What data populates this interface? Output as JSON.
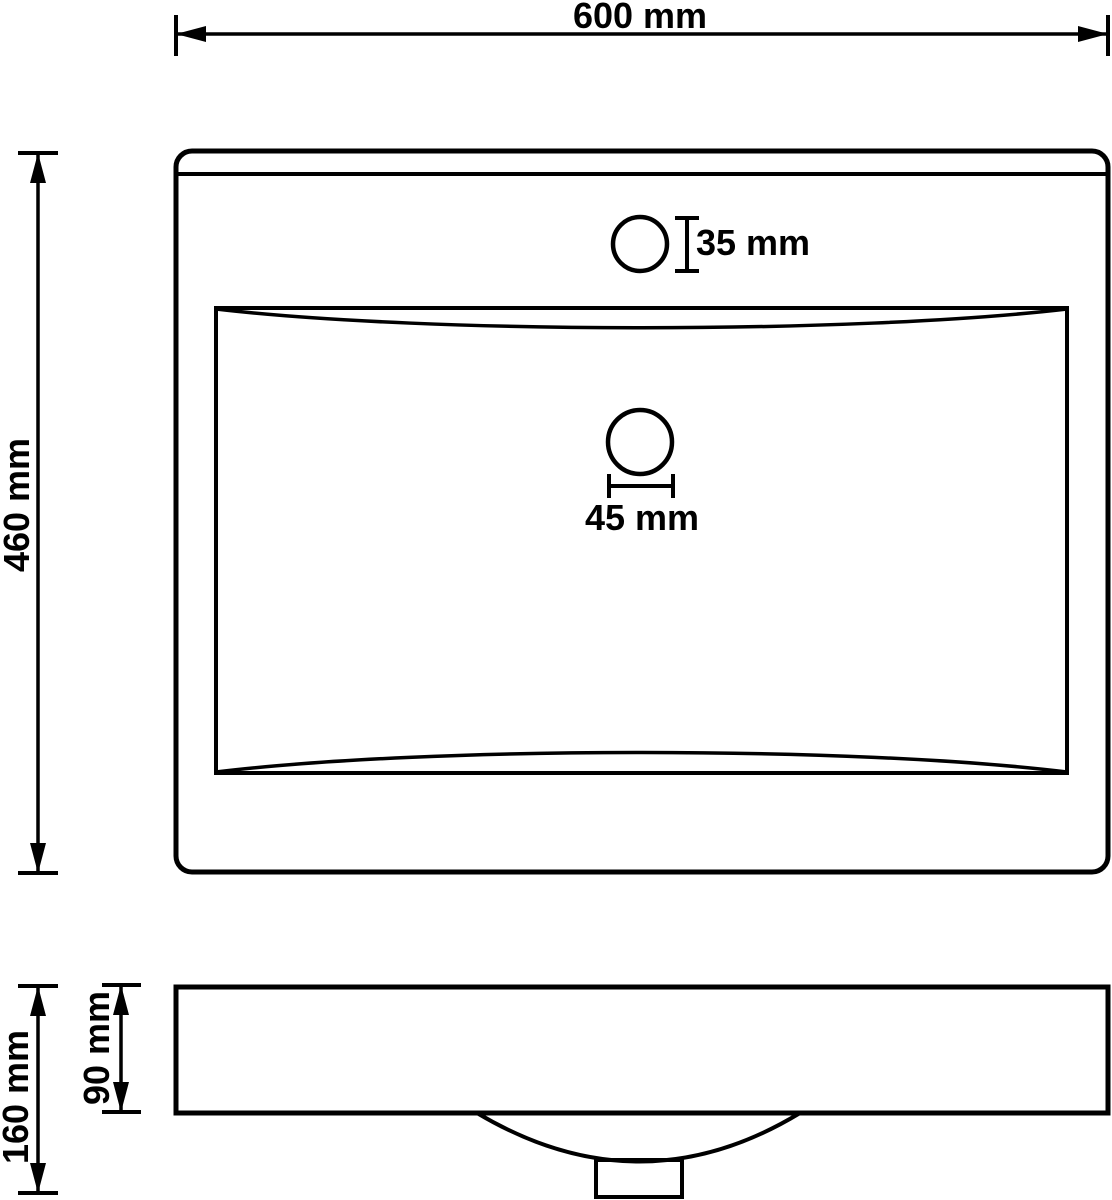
{
  "drawing": {
    "type": "technical-dimension-drawing",
    "subject": "rectangular wash basin, front and side orthographic views",
    "colors": {
      "background": "#ffffff",
      "line": "#000000",
      "text": "#000000"
    },
    "views": {
      "front": {
        "labels": {
          "width": "600 mm",
          "height": "460 mm",
          "faucet_hole": "35 mm",
          "drain_hole": "45 mm"
        }
      },
      "side": {
        "labels": {
          "total_height": "160 mm",
          "basin_height": "90 mm"
        }
      }
    }
  }
}
